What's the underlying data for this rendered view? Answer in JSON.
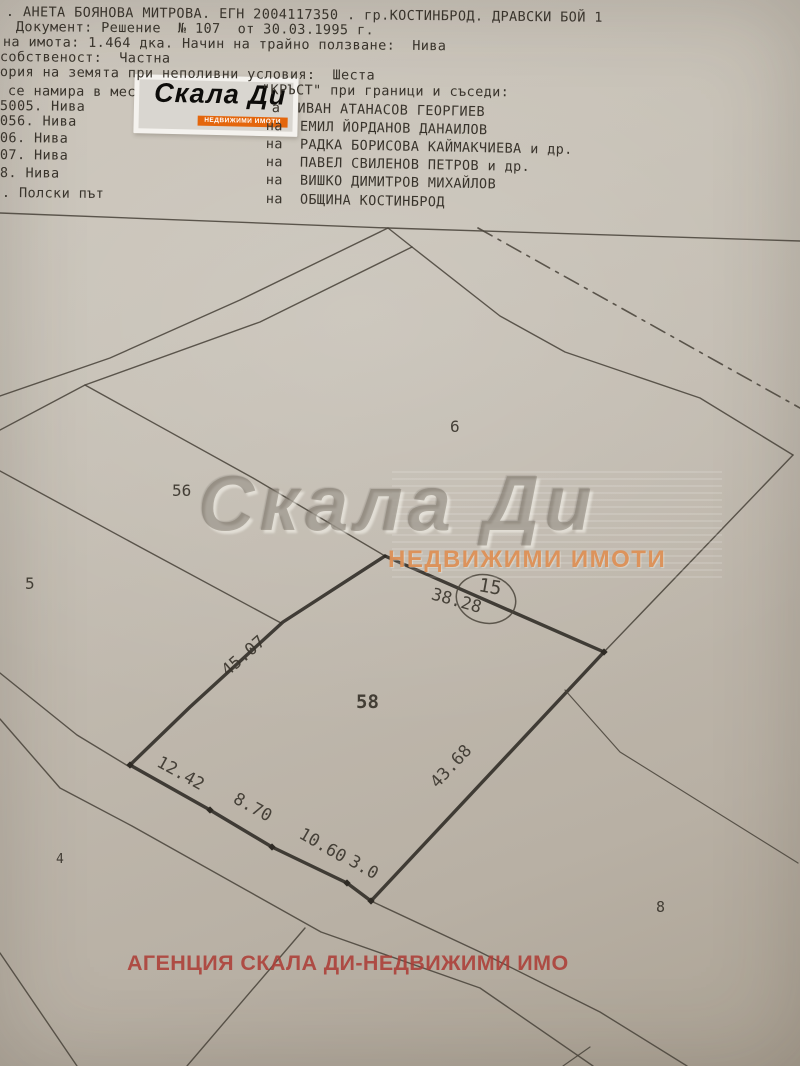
{
  "document": {
    "line1": ". АНЕТА БОЯНОВА МИТРОВА. ЕГН 2004117350 . гр.КОСТИНБРОД. ДРАВСКИ БОЙ 1",
    "line2": "Документ: Решение  № 107  от 30.03.1995 г.",
    "line3": "на имота: 1.464 дка. Начин на трайно ползване:  Нива",
    "line4": "собственост:  Частна",
    "line5": "ория на земята при неполивни условия:  Шеста",
    "line6_left": "се намира в мес",
    "line6_right": "\"КРЪСТ\" при граници и съседи:",
    "neighbors": [
      {
        "num": "5005. Нива",
        "owner": "а  ИВАН АТАНАСОВ ГЕОРГИЕВ"
      },
      {
        "num": "056. Нива",
        "owner": "на  ЕМИЛ ЙОРДАНОВ ДАНАИЛОВ"
      },
      {
        "num": "06. Нива",
        "owner": "на  РАДКА БОРИСОВА КАЙМАКЧИЕВА и др."
      },
      {
        "num": "07. Нива",
        "owner": "на  ПАВЕЛ СВИЛЕНОВ ПЕТРОВ и др."
      },
      {
        "num": "8. Нива",
        "owner": "на  ВИШКО ДИМИТРОВ МИХАЙЛОВ"
      },
      {
        "num": ". Полски път",
        "owner": "на  ОБЩИНА КОСТИНБРОД"
      }
    ]
  },
  "logo": {
    "brand": "Скала Ди",
    "tagline": "НЕДВИЖИМИ ИМОТИ"
  },
  "watermark": {
    "brand": "Скала Ди",
    "tagline": "НЕДВИЖИМИ ИМОТИ"
  },
  "footer_watermark": "АГЕНЦИЯ СКАЛА ДИ-НЕДВИЖИМИ ИМО",
  "colors": {
    "paper": "#c2bbb0",
    "ink": "#39342c",
    "line": "#4a443b",
    "bold_line": "#2e2a24",
    "logo_orange": "#e4660c",
    "watermark_orange": "#dc8f55",
    "footer_red": "#ac3e37"
  },
  "map": {
    "lines": [
      {
        "name": "top-boundary",
        "pts": [
          [
            0,
            213
          ],
          [
            388,
            228
          ],
          [
            800,
            241
          ]
        ],
        "w": 1.4
      },
      {
        "name": "fork-join",
        "pts": [
          [
            388,
            228
          ],
          [
            412,
            247
          ]
        ],
        "w": 1.4
      },
      {
        "name": "road-upper-edge",
        "pts": [
          [
            388,
            228
          ],
          [
            240,
            300
          ],
          [
            110,
            358
          ],
          [
            0,
            396
          ]
        ],
        "w": 1.4
      },
      {
        "name": "road-lower-edge",
        "pts": [
          [
            412,
            247
          ],
          [
            260,
            322
          ],
          [
            85,
            385
          ],
          [
            0,
            430
          ]
        ],
        "w": 1.4
      },
      {
        "name": "boundary-56-58",
        "pts": [
          [
            85,
            385
          ],
          [
            253,
            478
          ],
          [
            385,
            556
          ]
        ],
        "w": 1.4
      },
      {
        "name": "boundary-5-56",
        "pts": [
          [
            0,
            471
          ],
          [
            140,
            547
          ],
          [
            281,
            623
          ]
        ],
        "w": 1.4
      },
      {
        "name": "boundary-6-east",
        "pts": [
          [
            412,
            247
          ],
          [
            500,
            316
          ],
          [
            565,
            352
          ],
          [
            700,
            398
          ],
          [
            793,
            455
          ]
        ],
        "w": 1.4
      },
      {
        "name": "boundary-east-58",
        "pts": [
          [
            793,
            455
          ],
          [
            604,
            652
          ]
        ],
        "w": 1.4
      },
      {
        "name": "dash-dot-boundary",
        "pts": [
          [
            478,
            228
          ],
          [
            800,
            408
          ]
        ],
        "w": 1.6,
        "dash": "16 7 3 7"
      },
      {
        "name": "parcel-58-top",
        "pts": [
          [
            385,
            556
          ],
          [
            604,
            652
          ]
        ],
        "w": 3.4
      },
      {
        "name": "parcel-58-right",
        "pts": [
          [
            604,
            652
          ],
          [
            371,
            901
          ]
        ],
        "w": 3.4
      },
      {
        "name": "parcel-58-left",
        "pts": [
          [
            385,
            556
          ],
          [
            283,
            622
          ],
          [
            190,
            707
          ],
          [
            130,
            765
          ]
        ],
        "w": 3.4
      },
      {
        "name": "parcel-58-bottom",
        "pts": [
          [
            130,
            765
          ],
          [
            210,
            810
          ],
          [
            272,
            847
          ],
          [
            347,
            883
          ],
          [
            371,
            901
          ]
        ],
        "w": 3.4
      },
      {
        "name": "road2-upper-west",
        "pts": [
          [
            0,
            673
          ],
          [
            77,
            735
          ],
          [
            128,
            766
          ]
        ],
        "w": 1.4
      },
      {
        "name": "road2-upper-east",
        "pts": [
          [
            371,
            901
          ],
          [
            480,
            952
          ],
          [
            600,
            1012
          ],
          [
            687,
            1066
          ]
        ],
        "w": 1.4
      },
      {
        "name": "road2-lower",
        "pts": [
          [
            0,
            719
          ],
          [
            60,
            788
          ],
          [
            132,
            826
          ],
          [
            321,
            932
          ],
          [
            480,
            988
          ],
          [
            593,
            1066
          ]
        ],
        "w": 1.4
      },
      {
        "name": "boundary-8-north",
        "pts": [
          [
            565,
            690
          ],
          [
            620,
            752
          ],
          [
            798,
            863
          ]
        ],
        "w": 1.2
      },
      {
        "name": "boundary-sw",
        "pts": [
          [
            0,
            953
          ],
          [
            77,
            1066
          ]
        ],
        "w": 1.4
      },
      {
        "name": "boundary-south",
        "pts": [
          [
            305,
            928
          ],
          [
            187,
            1066
          ]
        ],
        "w": 1.4
      },
      {
        "name": "boundary-south-2",
        "pts": [
          [
            590,
            1047
          ],
          [
            563,
            1066
          ]
        ],
        "w": 1.2
      }
    ],
    "vertex_markers": [
      [
        604,
        652
      ],
      [
        130,
        765
      ],
      [
        210,
        810
      ],
      [
        272,
        847
      ],
      [
        347,
        883
      ],
      [
        371,
        901
      ]
    ],
    "circle": {
      "cx": 486,
      "cy": 599,
      "rx": 30,
      "ry": 24,
      "rotate": 14,
      "label": "15",
      "lx": 489,
      "ly": 593
    },
    "parcel_labels": [
      {
        "name": "parcel-6",
        "text": "6",
        "x": 450,
        "y": 432,
        "size": 16,
        "bold": false
      },
      {
        "name": "parcel-56",
        "text": "56",
        "x": 172,
        "y": 496,
        "size": 16,
        "bold": false
      },
      {
        "name": "parcel-5",
        "text": "5",
        "x": 25,
        "y": 589,
        "size": 16,
        "bold": false
      },
      {
        "name": "parcel-58",
        "text": "58",
        "x": 356,
        "y": 708,
        "size": 19,
        "bold": true
      },
      {
        "name": "parcel-8",
        "text": "8",
        "x": 656,
        "y": 912,
        "size": 15,
        "bold": false
      },
      {
        "name": "parcel-4",
        "text": "4",
        "x": 56,
        "y": 863,
        "size": 13,
        "bold": false
      }
    ],
    "measurements": [
      {
        "name": "m-45-07",
        "text": "45.07",
        "x": 247,
        "y": 660,
        "rotate": -41,
        "size": 17
      },
      {
        "name": "m-38-28",
        "text": "38.28",
        "x": 455,
        "y": 606,
        "rotate": 16,
        "size": 17
      },
      {
        "name": "m-43-68",
        "text": "43.68",
        "x": 455,
        "y": 770,
        "rotate": -47,
        "size": 17
      },
      {
        "name": "m-12-42",
        "text": "12.42",
        "x": 178,
        "y": 778,
        "rotate": 29,
        "size": 17
      },
      {
        "name": "m-8-70",
        "text": "8.70",
        "x": 250,
        "y": 812,
        "rotate": 29,
        "size": 17
      },
      {
        "name": "m-10-60",
        "text": "10.60",
        "x": 320,
        "y": 850,
        "rotate": 30,
        "size": 17
      },
      {
        "name": "m-3-0",
        "text": "3.0",
        "x": 361,
        "y": 872,
        "rotate": 30,
        "size": 17
      }
    ]
  }
}
